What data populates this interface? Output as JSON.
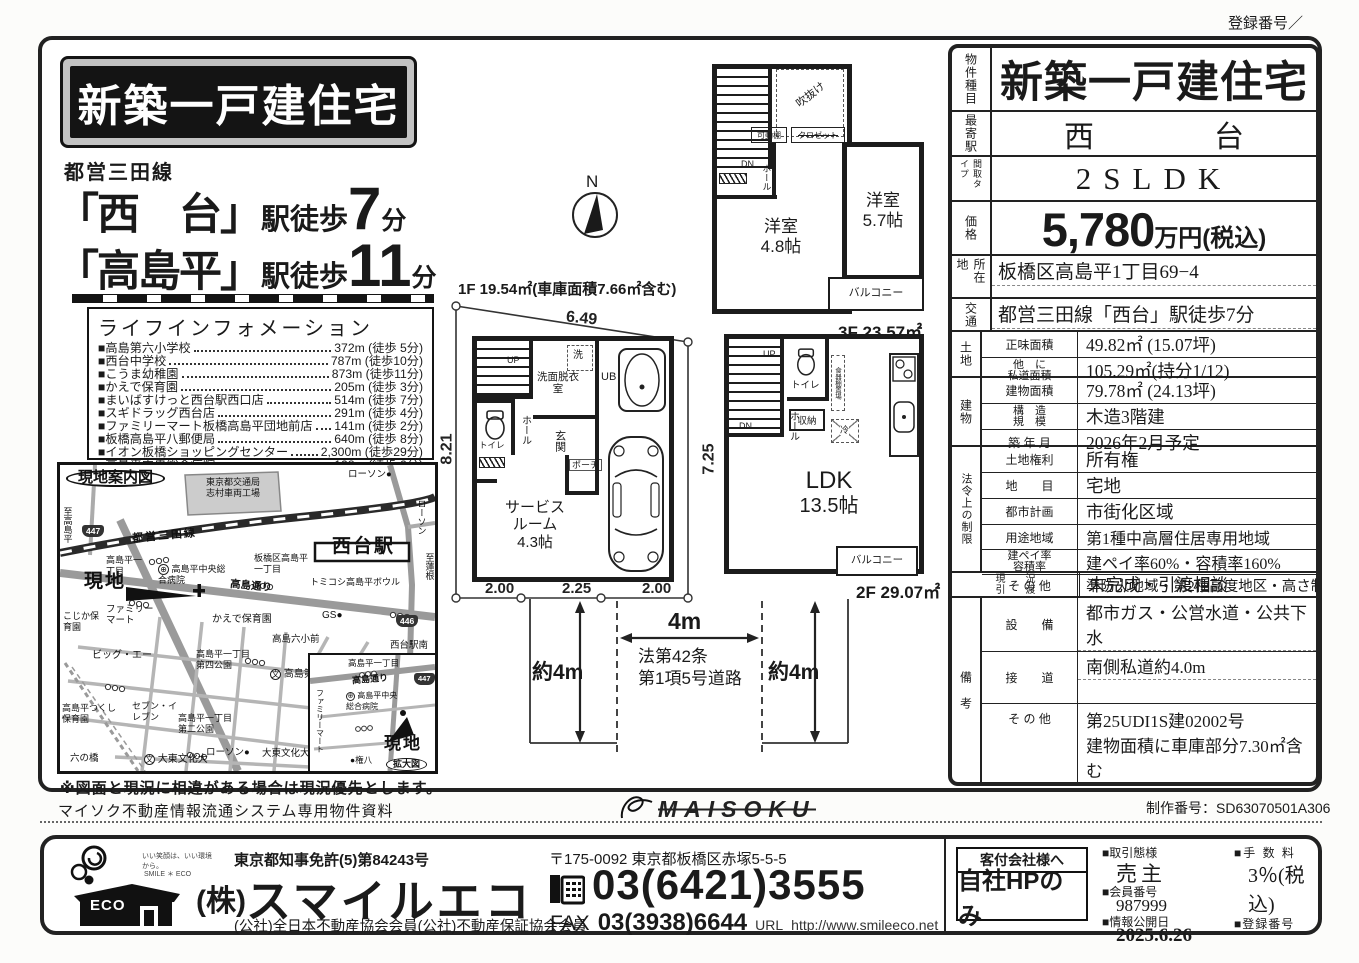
{
  "page": {
    "registration_top": "登録番号／",
    "production_no": "制作番号：SD63070501A306",
    "maisoku_text": "マイソク不動産情報流通システム専用物件資料",
    "maisoku_logo": "MAISOKU"
  },
  "header": {
    "banner": "新築一戸建住宅",
    "rail_line": "都営三田線",
    "stations": [
      {
        "name": "「西　台」",
        "prefix": "駅徒歩",
        "minutes": "7",
        "unit": "分"
      },
      {
        "name": "「高島平」",
        "prefix": "駅徒歩",
        "minutes": "11",
        "unit": "分"
      }
    ]
  },
  "life": {
    "title": "ライフインフォメーション",
    "items": [
      {
        "name": "■高島第六小学校",
        "value": "372m (徒歩 5分)"
      },
      {
        "name": "■西台中学校",
        "value": "787m (徒歩10分)"
      },
      {
        "name": "■こうま幼稚園",
        "value": "873m (徒歩11分)"
      },
      {
        "name": "■かえで保育園",
        "value": "205m (徒歩 3分)"
      },
      {
        "name": "■まいばすけっと西台駅西口店",
        "value": "514m (徒歩 7分)"
      },
      {
        "name": "■スギドラッグ西台店",
        "value": "291m (徒歩 4分)"
      },
      {
        "name": "■ファミリーマート板橋高島平団地前店",
        "value": "141m (徒歩 2分)"
      },
      {
        "name": "■板橋高島平八郵便局",
        "value": "640m (徒歩 8分)"
      },
      {
        "name": "■イオン板橋ショッピングセンター",
        "value": "2,300m (徒歩29分)"
      },
      {
        "name": "■高島平中央総合病院",
        "value": "128m (徒歩 2分)"
      }
    ]
  },
  "map": {
    "title": "現地案内図",
    "note": "※図面と現況に相違がある場合は現況優先とします。",
    "labels": {
      "factory1": "東京都交通局",
      "factory2": "志村車両工場",
      "lawson_top": "ローソン●",
      "to_left": "至高島平",
      "r447": "447",
      "mita": "都営三田線",
      "station": "西台駅",
      "lawson_right": "ローソン",
      "to_right": "至蓮根",
      "chome1": "高島平一丁目",
      "itabashi": "板橋区高島平一丁目",
      "bowl": "トミコシ高島平ボウル",
      "hosp_sym": "⊕",
      "hosp": "高島平中央総合病院",
      "genchi": "現地",
      "fm": "ファミリーマート",
      "kojika": "こじか保育園",
      "kaede": "かえで保育園",
      "gs": "GS●",
      "r446": "446",
      "sta_minami": "西台駅南",
      "biga": "ビッグ・エー",
      "park4": "高島平一丁目第四公園",
      "roku_mae": "高島六小前",
      "school_sym": "文",
      "school6": "高島第六小",
      "takashima_dori": "高島通り",
      "tsukushi": "高島平つくし保育園",
      "seven": "セブン・イレブン",
      "park2": "高島平一丁目第二公園",
      "lawson_b": "ローソン●",
      "daito_sym": "文",
      "daito": "大東文化大",
      "daito_mae": "大東文化大前",
      "rokubashi": "六の橋",
      "i_chome": "高島平一丁目",
      "i_dori": "高島通り",
      "i_447": "447",
      "i_hosp": "高島平中央総合病院",
      "i_fm": "ファミリーマート",
      "i_genchi": "現地",
      "i_kakudai": "拡大図",
      "i_gonpachi": "●権八"
    }
  },
  "plans": {
    "compass": "N",
    "f1": {
      "title": "1F 19.54㎡(車庫面積7.66㎡含む)",
      "dim_top": "6.49",
      "dim_left": "8.21",
      "dim_right": "7.25",
      "dim_b1": "2.00",
      "dim_b2": "2.25",
      "dim_b3": "2.00",
      "up": "UP",
      "hall": "ホール",
      "toilet": "トイレ",
      "wash": "洗面脱衣室",
      "laundry": "洗",
      "ub": "UB",
      "entrance": "玄関",
      "porch": "ポーチ",
      "service1": "サービス",
      "service2": "ルーム",
      "service3": "4.3帖"
    },
    "f2": {
      "label": "2F 29.07㎡",
      "up": "UP",
      "dn": "DN",
      "hall": "ホール",
      "toilet": "トイレ",
      "storage": "収納",
      "fridge": "冷",
      "cupboard": "食器棚置場",
      "ldk": "LDK",
      "ldk_size": "13.5帖",
      "balcony": "バルコニー"
    },
    "f3": {
      "label": "3F 23.57㎡",
      "void": "吹抜け",
      "shelf": "可動棚",
      "closet": "クロゼット",
      "dn": "DN",
      "hall": "ホール",
      "room_a1": "洋室",
      "room_a2": "5.7帖",
      "room_b1": "洋室",
      "room_b2": "4.8帖",
      "balcony": "バルコニー"
    },
    "road": {
      "center": "4m",
      "left": "約4m",
      "right": "約4m",
      "law1": "法第42条",
      "law2": "第1項5号道路"
    }
  },
  "table": {
    "property_type": {
      "label": "物件種目",
      "value": "新築一戸建住宅"
    },
    "station": {
      "label": "最寄駅",
      "value": "西　　　　台"
    },
    "layout": {
      "label": "間取タイプ",
      "value": "2SLDK"
    },
    "price": {
      "label": "価格",
      "number": "5,780",
      "suffix": "万円(税込)"
    },
    "location": {
      "label": "所在地",
      "value": "板橋区高島平1丁目69−4"
    },
    "access": {
      "label": "交通",
      "value": "都営三田線「西台」駅徒歩7分"
    },
    "land": {
      "label": "土地",
      "rows": [
        {
          "k": "正味面積",
          "v": "49.82㎡ (15.07坪)"
        },
        {
          "k1": "他　に",
          "k2": "私道面積",
          "v": "105.29㎡(持分1/12)"
        }
      ]
    },
    "building": {
      "label": "建物",
      "rows": [
        {
          "k": "建物面積",
          "v": "79.78㎡ (24.13坪)"
        },
        {
          "k1": "構　造",
          "k2": "規　模",
          "v": "木造3階建"
        },
        {
          "k": "築 年 月",
          "v": "2026年2月予定"
        }
      ]
    },
    "legal": {
      "label": "法令上の制限",
      "rows": [
        {
          "k": "土地権利",
          "v": "所有権"
        },
        {
          "k": "地　　目",
          "v": "宅地"
        },
        {
          "k": "都市計画",
          "v": "市街化区域"
        },
        {
          "k": "用途地域",
          "v": "第1種中高層住居専用地域"
        },
        {
          "k1": "建ペイ率",
          "k2": "容積率",
          "v": "建ペイ率60%・容積率160%"
        },
        {
          "k": "そ の 他",
          "v": "準防火地域・第2種高度地区・高さ制限17m"
        }
      ]
    },
    "status": {
      "k1": "現　　況",
      "k2": "引　　渡",
      "v": "未完成・引渡相談"
    },
    "remarks": {
      "label": "備　考",
      "rows": [
        {
          "k": "設　　備",
          "v": "都市ガス・公営水道・公共下水"
        },
        {
          "k": "接　　道",
          "v": "南側私道約4.0m"
        },
        {
          "k": "そ の 他",
          "v1": "第25UDI1S建02002号",
          "v2": "建物面積に車庫部分7.30㎡含む"
        }
      ]
    }
  },
  "footer": {
    "license": "東京都知事免許(5)第84243号",
    "company_prefix": "(株)",
    "company": "スマイルエコ",
    "memberships": "(公社)全日本不動産協会会員(公社)不動産保証協会会員",
    "postal": "〒175-0092 東京都板橋区赤塚5-5-5",
    "tel": "03(6421)3555",
    "fax_label": "FAX",
    "fax": "03(3938)6644",
    "url_label": "URL",
    "url": "http://www.smileeco.net",
    "logo_text": "ECO",
    "logo_slogan": "いい笑顔は、いい環境から。",
    "logo_smile": "SMILE ＊ ECO",
    "agent_title": "客付会社様へ",
    "agent_value": "自社HPのみ",
    "deal_label": "■取引態様",
    "deal_value": "売主",
    "member_label": "■会員番号",
    "member_value": "987999",
    "publish_label": "■情報公開日",
    "publish_value": "2025.6.26",
    "fee_label": "■手 数 料",
    "fee_value": "3％(税込)",
    "reg_label": "■登録番号"
  }
}
